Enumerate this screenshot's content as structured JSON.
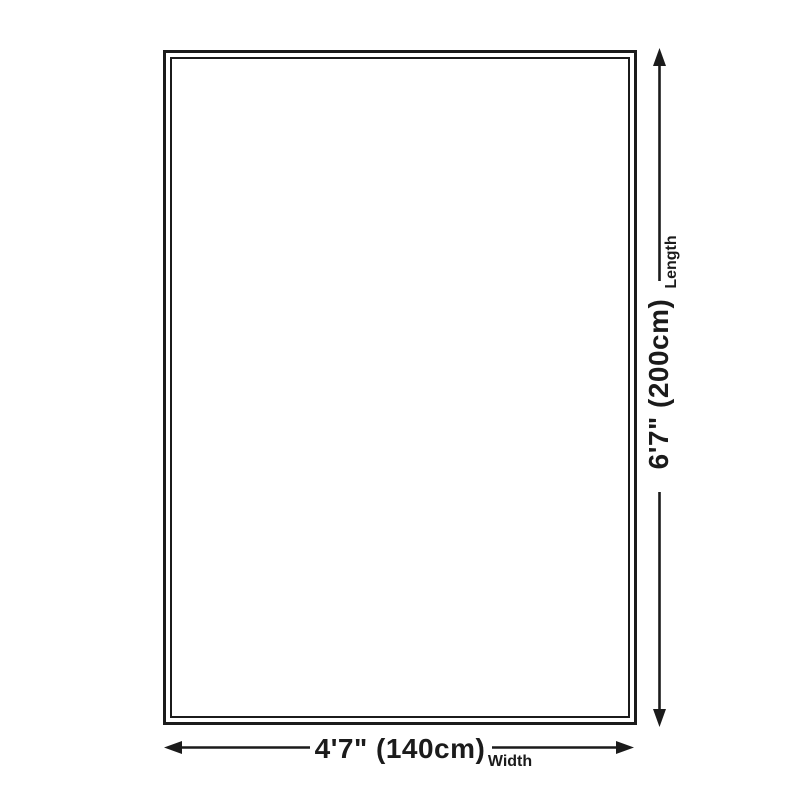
{
  "diagram": {
    "length": {
      "value": "6'7\" (200cm)",
      "label": "Length"
    },
    "width": {
      "value": "4'7\" (140cm)",
      "label": "Width"
    },
    "colors": {
      "line": "#1b1b1b",
      "background": "#ffffff"
    }
  }
}
